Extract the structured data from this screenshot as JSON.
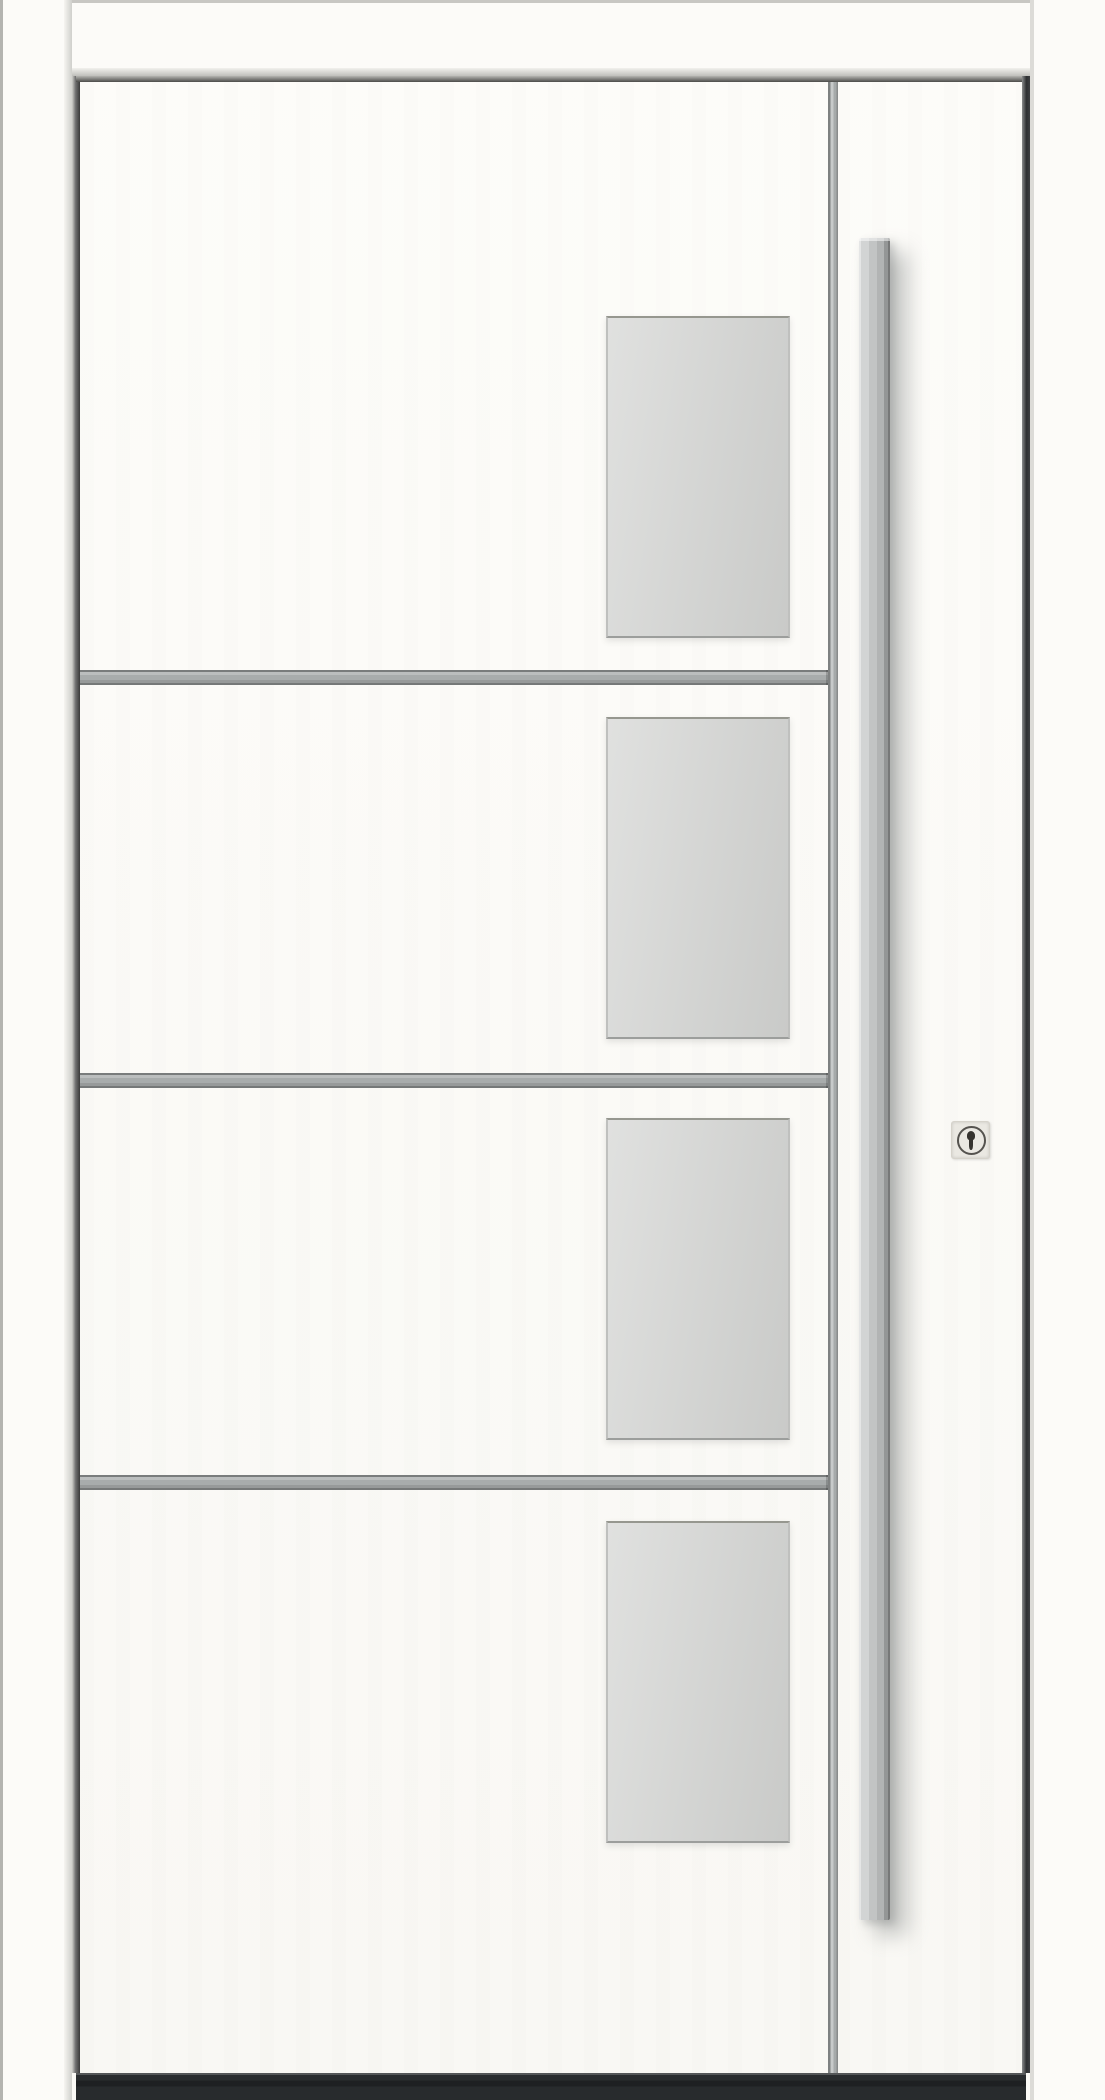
{
  "meta": {
    "subject": "White entrance door, front view, with four frosted glass panes, three horizontal aluminium divider bars, a vertical trim strip, a long stainless steel pull handle and a security cylinder lock above a dark threshold"
  },
  "colors": {
    "background": "#fbfaf6",
    "frame_white": "#fcfbf8",
    "leaf_white": "#fcfbf7",
    "glass": "#d4d5d3",
    "aluminium": "#a8acac",
    "trim_strip": "#afb3b3",
    "handle_steel": "#c6c8c8",
    "lock_plate": "#eae8e2",
    "threshold_dark": "#2a2d2f",
    "edge_dark": "#363839"
  },
  "door": {
    "glass_pane_count": 4,
    "divider_count": 3,
    "handle": "vertical-bar-pull-handle",
    "lock": "profile-cylinder-with-security-rosette",
    "threshold": "dark-aluminium-threshold"
  }
}
